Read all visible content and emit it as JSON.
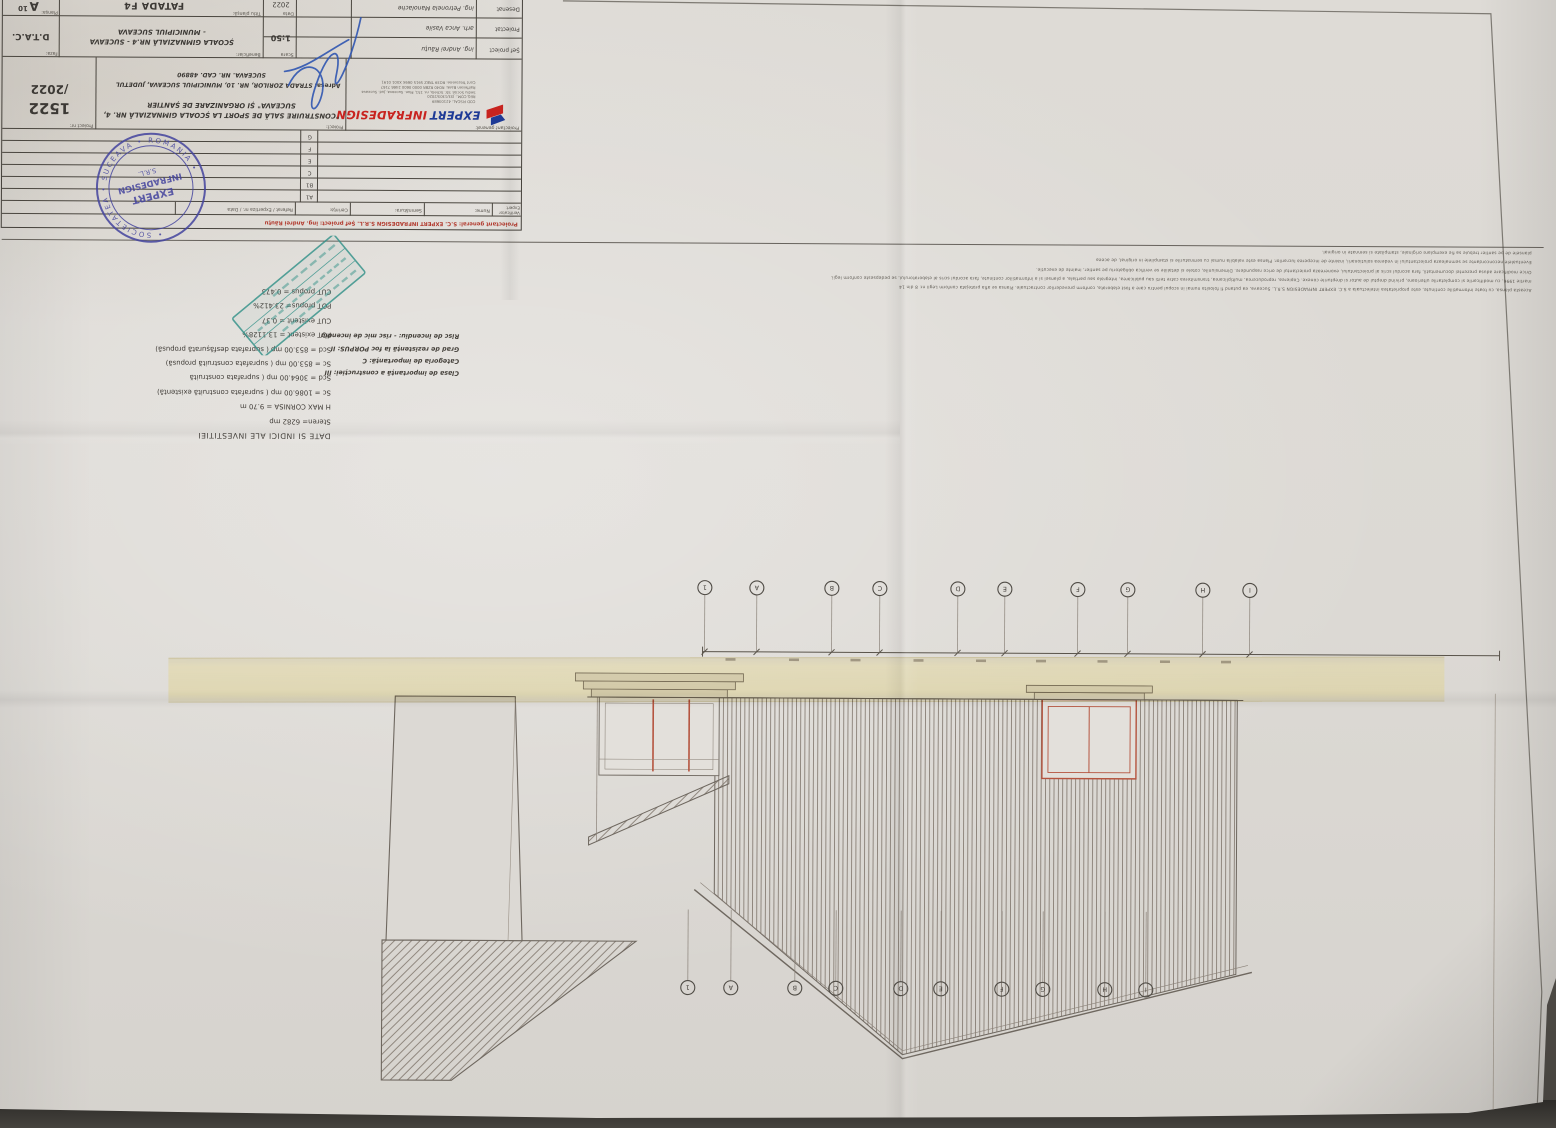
{
  "photo": {
    "background_color": "#55514c",
    "paper_color": "#dcd9d4",
    "tape_color": "#ded2a0",
    "orientation": "sheet photographed upside-down (rotated 180 degrees)"
  },
  "sheet": {
    "footer_red": "Proiectant general: S.C. EXPERT INFRADESIGN S.R.L.  Șef proiect: ing. Andrei Răuțu",
    "rev_header": [
      "Verificator Expert",
      "Nume:",
      "Semnătura:",
      "Cerința:",
      "Referat / Expertiza nr. / Data"
    ],
    "revisions": [
      "A1",
      "B1",
      "C",
      "E",
      "F",
      "G"
    ],
    "company": {
      "general_label": "Proiectant general:",
      "name1": "EXPERT",
      "name2": "INFRADESIGN",
      "lines": [
        "COD FISCAL: 42103689",
        "REG.COM.: J33/1303/2020",
        "Sediu Social: Str. Schela, nr. 151, Mun. Suceava, Jud. Suceava",
        "Raiffeisen Bank: RO40 RZBR 0000 0600 2466 7167",
        "Cont Trezorerie: RO39 TREZ 5915 069X XX01 0191"
      ]
    },
    "proiect_label": "Proiect:",
    "proiect1": "\"CONSTRUIRE SALĂ DE SPORT LA ȘCOALA GIMNAZIALĂ NR. 4,",
    "proiect2": "SUCEAVA\" ȘI ORGANIZARE DE ȘANTIER",
    "adresa_label": "Adresa:",
    "adresa1": "STRADA ZORILOR, NR. 10, MUNICIPIUL SUCEAVA, JUDETUL",
    "adresa2": "SUCEAVA. NR. CAD. 48890",
    "proiect_nr_label": "Proiect nr:",
    "proiect_nr": "1522",
    "proiect_nr2": "/2022",
    "staff": [
      {
        "role": "Șef proiect",
        "name": "ing. Andrei Răuțu"
      },
      {
        "role": "Proiectat",
        "name": "arh. Anca Vasile"
      },
      {
        "role": "Desenat",
        "name": "ing. Petronela Manolache"
      }
    ],
    "scara_label": "Scara",
    "scara": "1:50",
    "data_label": "Data",
    "data": "2022",
    "beneficiar_label": "Beneficiar:",
    "beneficiar1": "ȘCOALA GIMNAZIALĂ NR.4 - SUCEAVA",
    "beneficiar2": "- MUNICIPIUL SUCEAVA",
    "titlu_label": "Titlu planșă:",
    "titlu": "FATADA F4",
    "plansa_label": "Planșa:",
    "plansa": "A",
    "plansa_no": "10",
    "faza_label": "Faza:",
    "faza": "D.T.A.C."
  },
  "notes": {
    "fine_print_lines": [
      "Aceasta plansa, cu toate informatiile continute, este proprietatea intelectuala a S.C. EXPERT INFRADESIGN S.R.L. Suceava, ea putand fi folosita numai in scopul pentru care a fost elaborata, conform prevederilor contractuale. Plansa se afla protejata conform Legii nr. 8 din 14",
      "martie 1996, cu modificarile si completarile ulterioare, privind dreptul de autor si drepturile conexe. Copierea, reproducerea, multiplicarea, transmiterea catre terti sau publicarea, integrala sau partiala, a plansei si a informatiilor continute, fara acordul scris al elaboratorului, se pedepseste conform legii.",
      "Orice modificare adusa prezentei documentatii, fara acordul scris al proiectantului, exonereaza proiectantul de orice raspundere. Dimensiunile, cotele si detaliile se verifica obligatoriu pe santier, inainte de executie.",
      "Eventualele neconcordante se semnaleaza proiectantului in vederea solutionarii, inainte de inceperea lucrarilor. Plansa este valabila numai cu semnaturile si stampilele in original, de aceea",
      "plansele de pe santier trebuie sa fie exemplare originale, stampilate si semnate in original."
    ],
    "indices_title": "DATE SI INDICI ALE INVESTITIEI",
    "indices": [
      "Steren= 6282 mp",
      "H MAX CORNISA = 9.70 m",
      "Sc = 1086.00 mp ( suprafata construită existentă)",
      "Scd = 3064.00 mp ( suprafata construită",
      "Sc = 853.00 mp ( suprafata construită propusă)",
      "Scd = 853.00 mp ( suprafata desfășurată propusă)",
      "POT existent = 13.1128%",
      "CUT existent = 0.37",
      "POT propus= 23.412%",
      "CUT propus = 0.473"
    ],
    "class_info": [
      "Clasa de importanță a construcției: III",
      "Categoria de importanță: C",
      "Grad de rezistență la foc PORPUS: II",
      "Risc de incendiu: - risc mic de incendiu"
    ]
  },
  "stamps": {
    "round": {
      "ring": "• SOCIETATEA • SUCEAVA • ROMANIA •",
      "line1": "EXPERT",
      "line2": "INFRADESIGN",
      "line3": "S.R.L.",
      "color": "#43439e"
    },
    "angled": {
      "color": "#2e8f86"
    }
  },
  "drawing": {
    "title": "FATADA F4",
    "axes_bottom": {
      "y": 540,
      "x": [
        306,
        353,
        428,
        478,
        551,
        598,
        676,
        724,
        799,
        851
      ],
      "labels": [
        "I",
        "H",
        "G",
        "F",
        "E",
        "D",
        "C",
        "B",
        "A",
        "1"
      ]
    },
    "axes_top": {
      "y": 140,
      "x": [
        408,
        449,
        511,
        552,
        613,
        653,
        718,
        759,
        823,
        866
      ],
      "labels": [
        "I",
        "H",
        "G",
        "F",
        "E",
        "D",
        "C",
        "B",
        "A",
        "1"
      ]
    },
    "dim_line": {
      "x1": 56,
      "x2": 853,
      "y": 476
    }
  }
}
